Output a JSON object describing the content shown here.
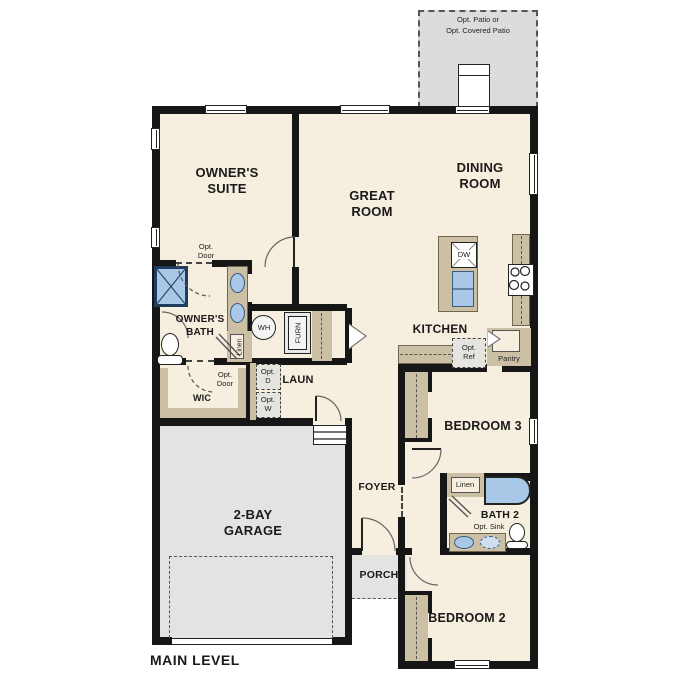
{
  "title": "MAIN LEVEL",
  "plan_name": "single-family home main level floor plan",
  "colors": {
    "floor": "#f6eede",
    "counter_tan": "#cbbfa4",
    "concrete_gray": "#e3e3e1",
    "patio_gray": "#dcdcda",
    "fixture_blue": "#a9c8e8",
    "wall_black": "#161616"
  },
  "labels": {
    "main_level": "MAIN LEVEL",
    "patio_1": "Opt. Patio or",
    "patio_2": "Opt. Covered Patio",
    "owners_suite_1": "OWNER'S",
    "owners_suite_2": "SUITE",
    "great_room_1": "GREAT",
    "great_room_2": "ROOM",
    "dining_room_1": "DINING",
    "dining_room_2": "ROOM",
    "kitchen": "KITCHEN",
    "owners_bath_1": "OWNER'S",
    "owners_bath_2": "BATH",
    "opt_door_1": "Opt.",
    "opt_door_2": "Door",
    "wic": "WIC",
    "linen": "Linen",
    "laundry": "LAUN",
    "opt_d_1": "Opt.",
    "opt_d_2": "D",
    "opt_w_1": "Opt.",
    "opt_w_2": "W",
    "wh": "WH",
    "furn": "FURN",
    "dw": "DW",
    "opt_ref_1": "Opt.",
    "opt_ref_2": "Ref",
    "pantry": "Pantry",
    "foyer": "FOYER",
    "porch": "PORCH",
    "garage_1": "2-BAY",
    "garage_2": "GARAGE",
    "bedroom3": "BEDROOM 3",
    "bedroom2": "BEDROOM 2",
    "bath2": "BATH 2",
    "opt_sink": "Opt. Sink"
  }
}
